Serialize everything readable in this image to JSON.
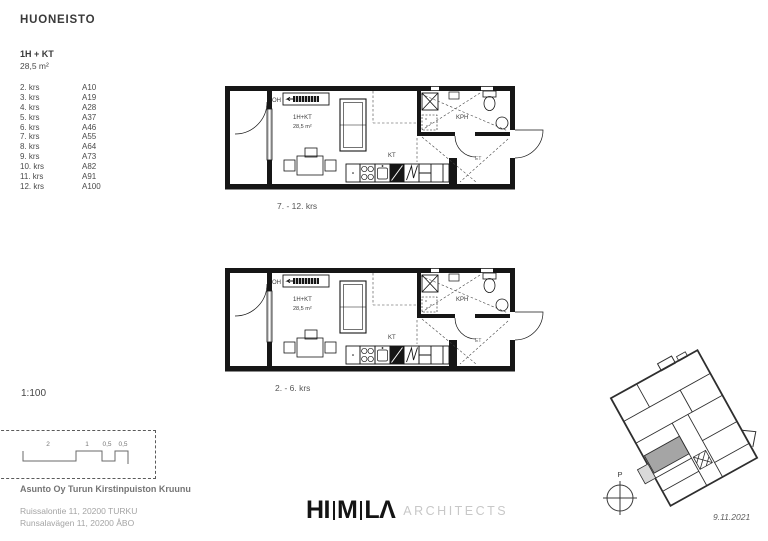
{
  "sheet": {
    "title": "HUONEISTO"
  },
  "apartment": {
    "type": "1H + KT",
    "area": "28,5 m²"
  },
  "floor_list": [
    {
      "floor": "2. krs",
      "unit": "A10"
    },
    {
      "floor": "3. krs",
      "unit": "A19"
    },
    {
      "floor": "4. krs",
      "unit": "A28"
    },
    {
      "floor": "5. krs",
      "unit": "A37"
    },
    {
      "floor": "6. krs",
      "unit": "A46"
    },
    {
      "floor": "7. krs",
      "unit": "A55"
    },
    {
      "floor": "8. krs",
      "unit": "A64"
    },
    {
      "floor": "9. krs",
      "unit": "A73"
    },
    {
      "floor": "10. krs",
      "unit": "A82"
    },
    {
      "floor": "11. krs",
      "unit": "A91"
    },
    {
      "floor": "12. krs",
      "unit": "A100"
    }
  ],
  "plans": {
    "caption_upper": "7. - 12. krs",
    "caption_lower": "2. - 6. krs",
    "labels": {
      "living": "OH",
      "type": "1H+KT",
      "area": "28,5 m²",
      "kitchen": "KT",
      "bathroom": "KPH",
      "entry": "ET"
    }
  },
  "scale": {
    "ratio": "1:100",
    "bar_labels": [
      "2",
      "1",
      "0,5",
      "0,5"
    ]
  },
  "project": {
    "name": "Asunto Oy Turun Kirstinpuiston Kruunu",
    "address_line1": "Ruissalontie 11, 20200 TURKU",
    "address_line2": "Runsalavägen 11, 20200 ÅBO"
  },
  "logo": {
    "part1": "HI",
    "part2": "M",
    "part3": "LΛ",
    "suffix": "ARCHITECTS"
  },
  "key_plan": {
    "north": "P",
    "date": "9.11.2021"
  },
  "colors": {
    "highlight": "#a5a5a5",
    "balcony_fill": "#d9d9d9",
    "glass": "#c9c9c9"
  }
}
